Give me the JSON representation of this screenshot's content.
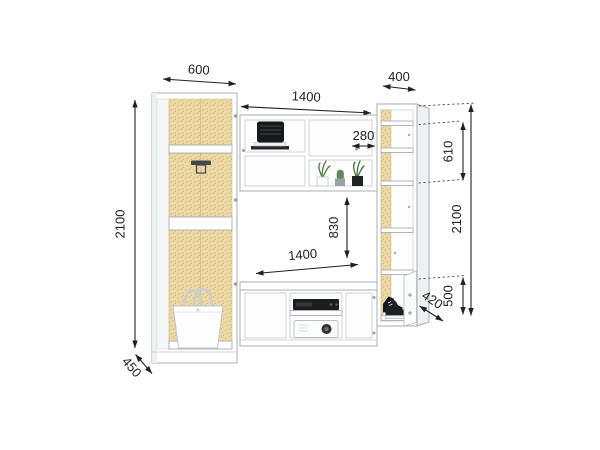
{
  "diagram": {
    "kind": "furniture dimension drawing",
    "subject": "white wall unit with open wardrobe, tv bridge shelves and shelving column",
    "colors": {
      "background": "#ffffff",
      "furniture_outline": "#a9afb5",
      "dimension_line": "#202124",
      "chipboard": "#ecd9a5",
      "chipboard_speckle": "#d8bd7c",
      "plant_green": "#4a7d44",
      "object_dark": "#1b1d20"
    },
    "dimensions": {
      "wardrobe_width": "600",
      "bridge_width": "1400",
      "column_width": "400",
      "niche_width": "280",
      "column_upper_height": "610",
      "column_total_height": "2100",
      "wardrobe_total_height": "2100",
      "tv_opening_height": "830",
      "tv_opening_width": "1400",
      "wardrobe_depth": "450",
      "column_depth": "420",
      "column_base_height": "500"
    }
  }
}
